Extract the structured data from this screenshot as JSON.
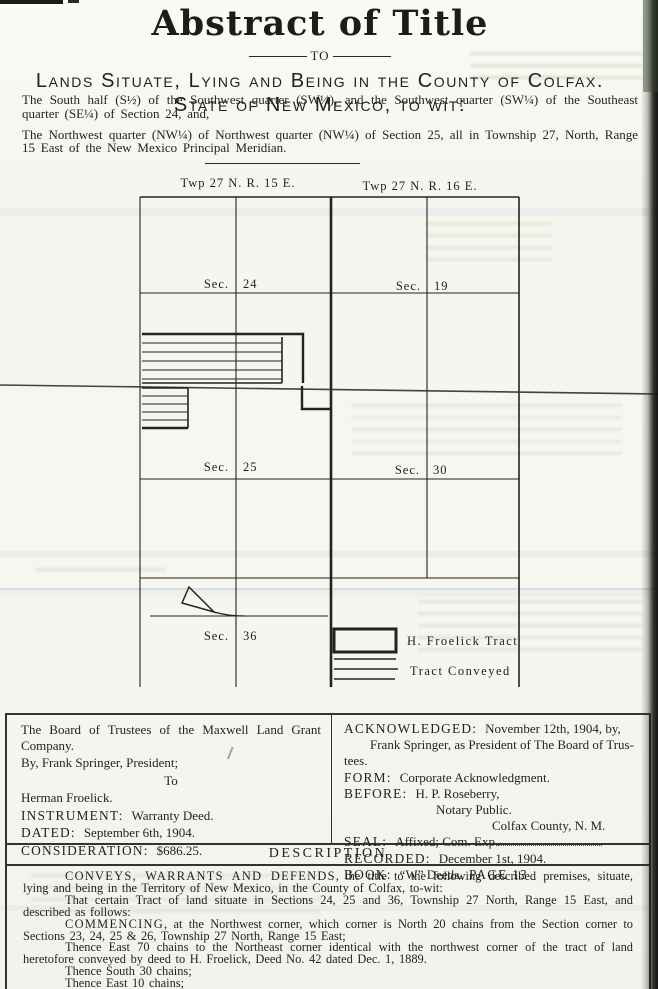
{
  "header": {
    "title": "Abstract of Title",
    "to_label": "TO",
    "subtitle_line1": "Lands Situate, Lying and Being in the County of Colfax.",
    "subtitle_line2": "State of New Mexico, to wit:"
  },
  "intro": {
    "para1": "The South half (S½) of the Southwest quarter (SW¼), and the Southwest quarter (SW¼) of the Southeast quarter (SE¼) of Section 24, and,",
    "para2": "The Northwest quarter (NW¼) of Northwest quarter (NW¼) of Section 25, all in Township 27, North, Range 15 East of the New Mexico Principal Meridian."
  },
  "map": {
    "twp_left": "Twp 27 N. R. 15 E.",
    "twp_right": "Twp 27 N. R. 16 E.",
    "sections": [
      {
        "label": "Sec.",
        "num": "24"
      },
      {
        "label": "Sec.",
        "num": "19"
      },
      {
        "label": "Sec.",
        "num": "25"
      },
      {
        "label": "Sec.",
        "num": "30"
      },
      {
        "label": "Sec.",
        "num": "36"
      }
    ],
    "legend": {
      "froelick_tract": "H. Froelick Tract",
      "tract_conveyed": "Tract Conveyed"
    }
  },
  "parties": {
    "grantor": "The Board of Trustees of the Maxwell Land Grant Company.",
    "by_line": "By, Frank Springer, President;",
    "to_label": "To",
    "grantee": "Herman Froelick.",
    "instrument_label": "INSTRUMENT:",
    "instrument_value": "Warranty Deed.",
    "dated_label": "DATED:",
    "dated_value": "September 6th, 1904.",
    "consideration_label": "CONSIDERATION:",
    "consideration_value": "$686.25."
  },
  "acknowledgment": {
    "ack_label": "ACKNOWLEDGED:",
    "ack_value": "November 12th, 1904, by,",
    "ack_cont1": "Frank Springer, as President of The Board of Trus-",
    "ack_cont2": "tees.",
    "form_label": "FORM:",
    "form_value": "Corporate Acknowledgment.",
    "before_label": "BEFORE:",
    "before_value": "H. P. Roseberry,",
    "notary_line": "Notary Public.",
    "county_line": "Colfax County, N. M.",
    "seal_label": "SEAL:",
    "seal_value": "Affixed; Com. Exp.",
    "recorded_label": "RECORDED:",
    "recorded_value": "December 1st, 1904.",
    "book_label": "BOOK:",
    "book_value": "“W” Deeds.",
    "page_value": "PAGE 13"
  },
  "description": {
    "heading": "DESCRIPTION",
    "paragraphs": [
      {
        "lead": "CONVEYS, WARRANTS AND DEFENDS,",
        "text": "the title to the following described premises, situate, lying and being in the Territory of New Mexico, in the County of Colfax, to-wit:"
      },
      {
        "lead": "",
        "text": "That certain Tract of land situate in Sections 24, 25 and 36, Township 27 North, Range 15 East, and described as follows:"
      },
      {
        "lead": "COMMENCING,",
        "text": "at the Northwest corner, which corner is North 20 chains from the Section corner to Sections 23, 24, 25 & 26, Township 27 North, Range 15 East;"
      },
      {
        "lead": "",
        "text": "Thence East 70 chains to the Northeast corner identical with the northwest corner of the tract of land heretofore conveyed by deed to H. Froelick, Deed No. 42 dated Dec. 1, 1889."
      },
      {
        "lead": "",
        "text": "Thence South 30 chains;"
      },
      {
        "lead": "",
        "text": "Thence East 10 chains;"
      },
      {
        "lead": "",
        "text": "Thence South 20 chains;"
      }
    ]
  }
}
